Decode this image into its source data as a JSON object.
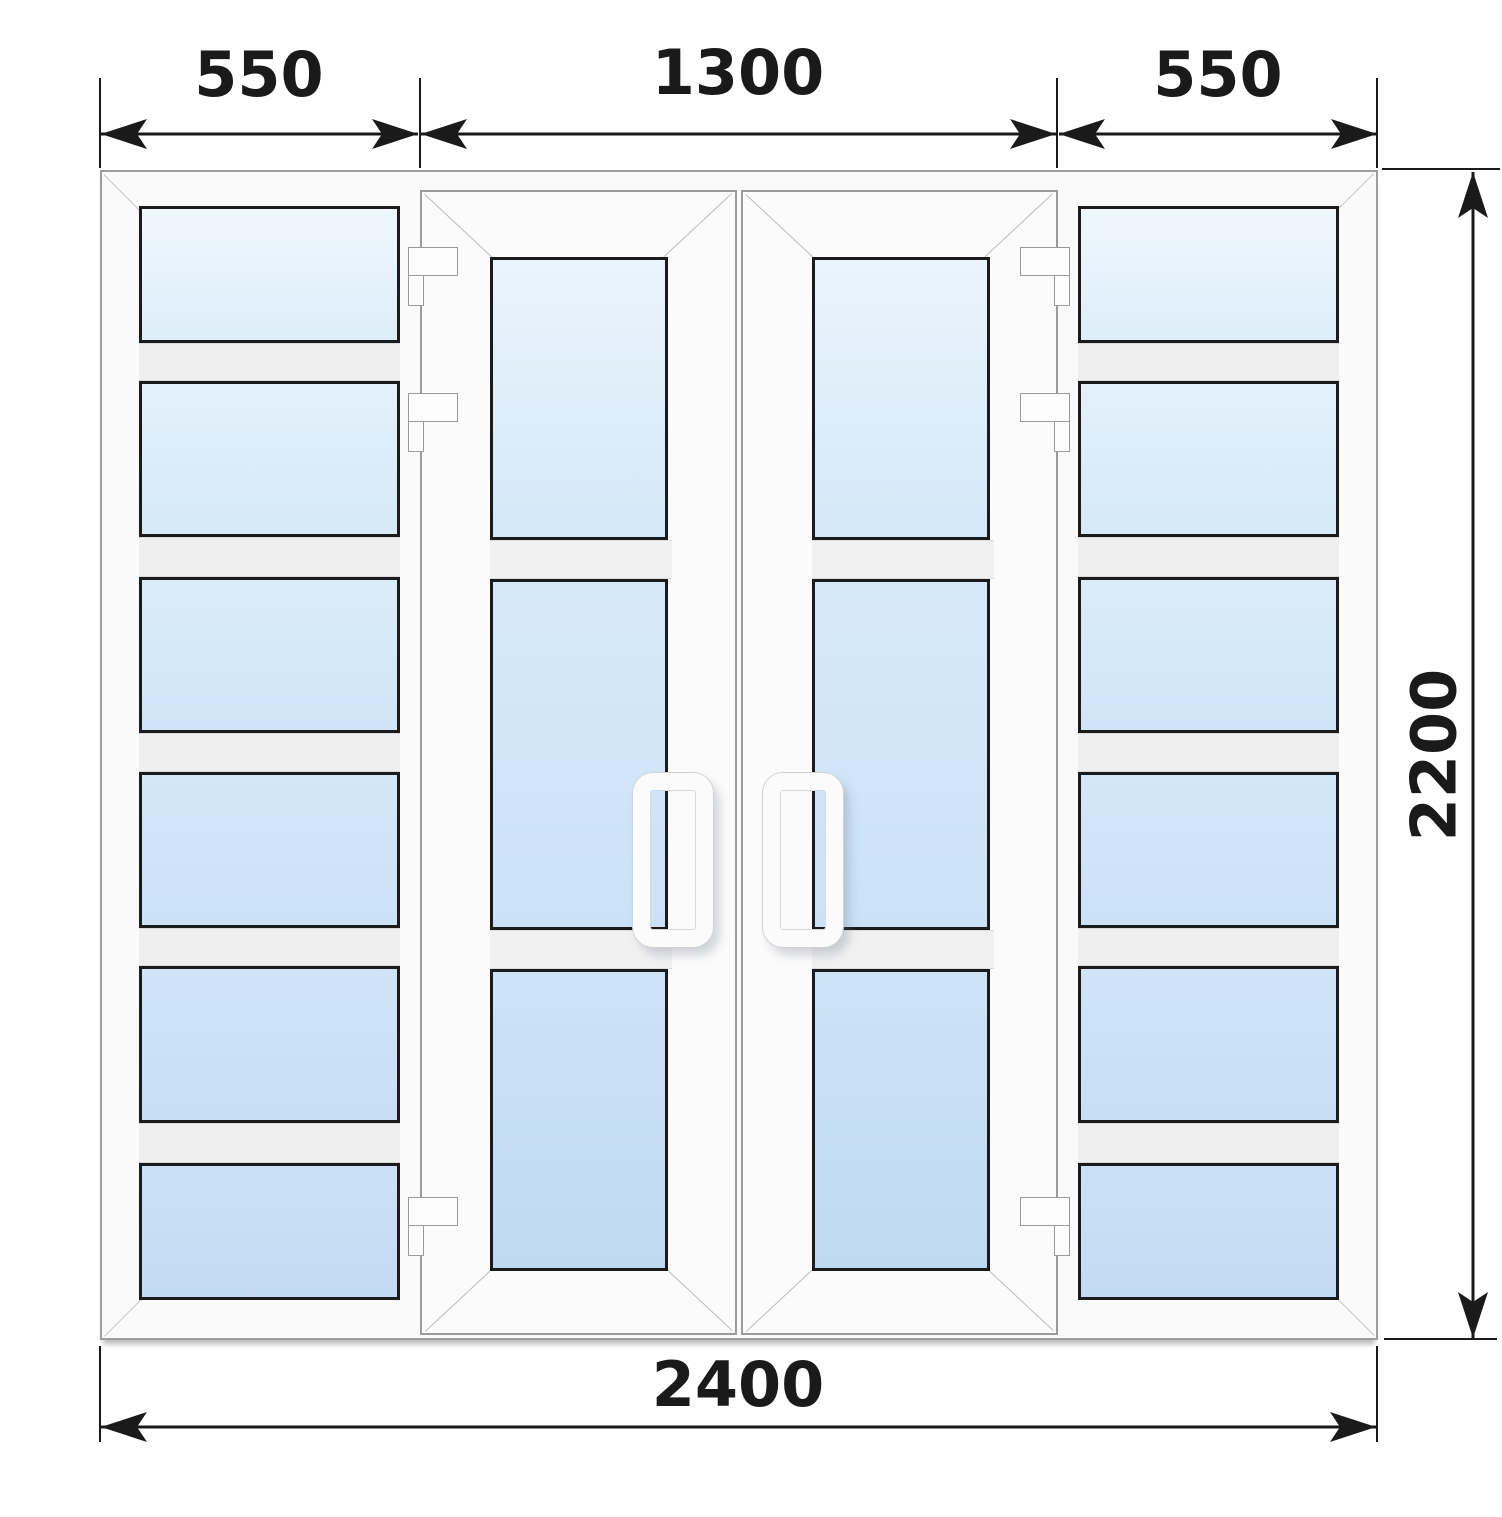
{
  "dimensions": {
    "top_segments": [
      {
        "label": "550"
      },
      {
        "label": "1300"
      },
      {
        "label": "550"
      }
    ],
    "bottom": {
      "label": "2400"
    },
    "right": {
      "label": "2200"
    }
  },
  "structure": {
    "left_sidelight_pane_count": 6,
    "right_sidelight_pane_count": 6,
    "door_count": 2,
    "panes_per_door": 3,
    "hinges_per_door": 3,
    "handle_count": 2
  },
  "colors": {
    "glass_light": "#eff7fd",
    "glass_dark": "#c0d9f2",
    "frame_white": "#fafafa",
    "pane_border": "#1b1b1b",
    "dimension_ink": "#1a1a1a"
  }
}
